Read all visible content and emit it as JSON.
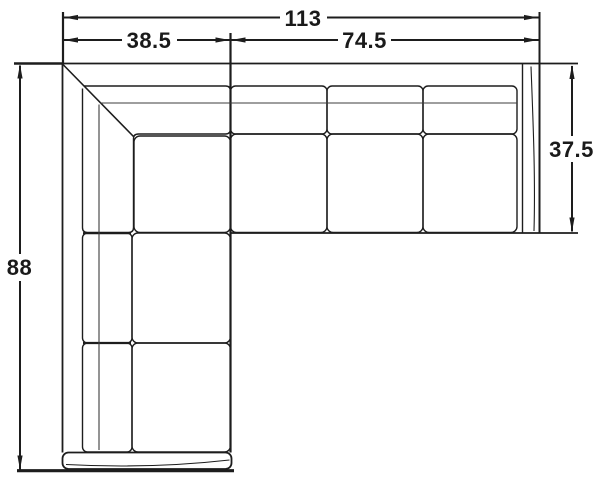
{
  "diagram": {
    "line_color": "#1d1d1d",
    "background_color": "#ffffff",
    "dimensions": {
      "overall_width": {
        "label": "113"
      },
      "chaise_section_width": {
        "label": "38.5"
      },
      "sofa_section_width": {
        "label": "74.5"
      },
      "chaise_section_depth": {
        "label": "88"
      },
      "sofa_section_depth": {
        "label": "37.5"
      }
    }
  }
}
